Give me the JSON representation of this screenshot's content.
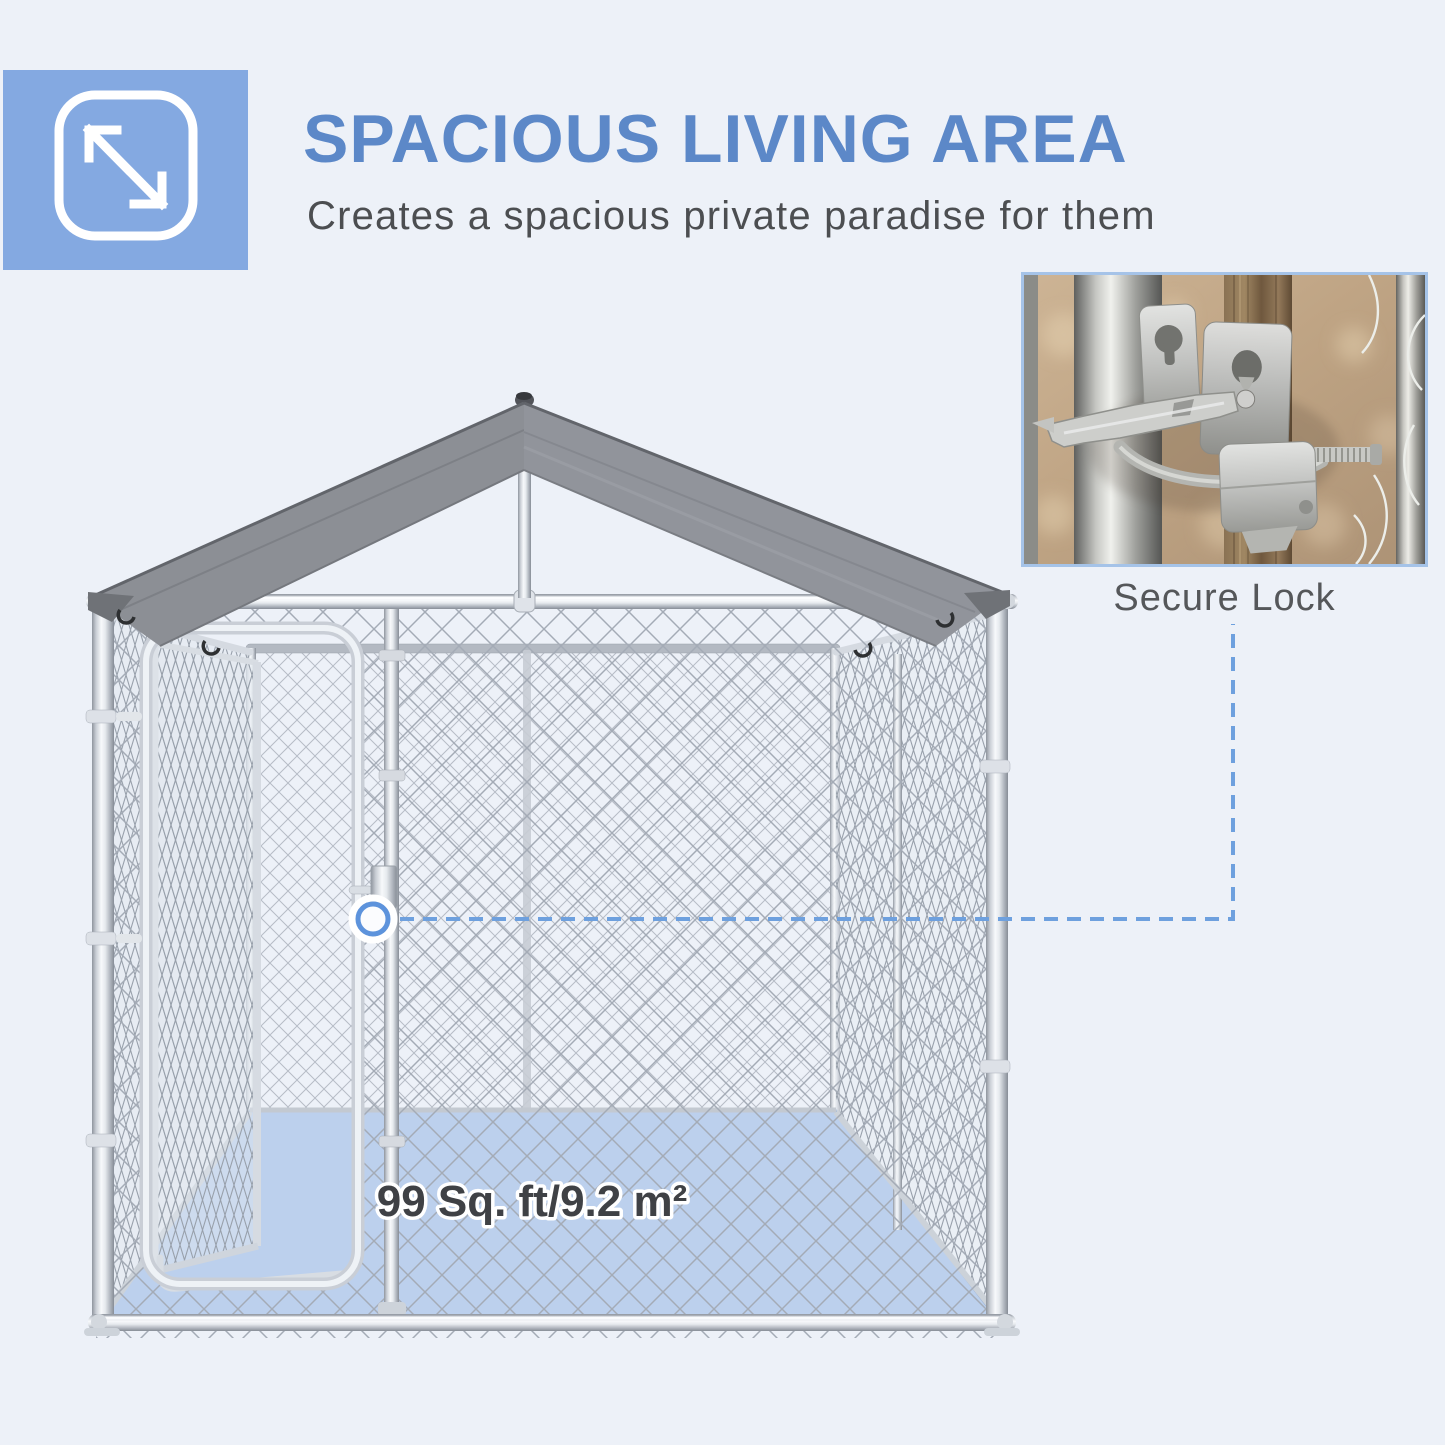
{
  "header": {
    "title": "SPACIOUS LIVING AREA",
    "subtitle": "Creates a spacious private paradise for them",
    "badge_icon": "expand-arrows-icon"
  },
  "kennel": {
    "floor_area_label": "99 Sq. ft/9.2 m²"
  },
  "inset": {
    "caption": "Secure Lock"
  },
  "colors": {
    "background": "#edf1f8",
    "accent_blue": "#5c88c8",
    "badge_blue": "#84a9e1",
    "connector_blue": "#6ea0de",
    "floor_blue": "#b7cdec",
    "roof_gray_left": "#8c8f95",
    "roof_gray_right": "#91949b",
    "subtitle_gray": "#4c4e51",
    "caption_gray": "#55575a"
  }
}
